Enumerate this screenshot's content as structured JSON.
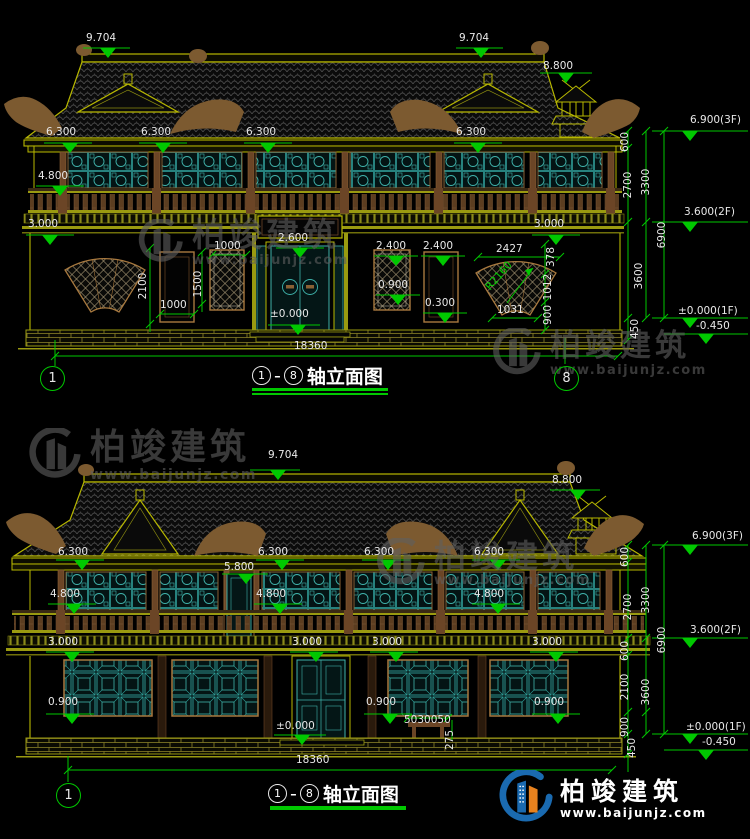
{
  "watermark": {
    "brand": "柏竣建筑",
    "url": "www.baijunjz.com"
  },
  "axes": {
    "a1": "1",
    "a8": "8"
  },
  "titles": {
    "top": "轴立面图",
    "bottom": "轴立面图",
    "separator": "-"
  },
  "lv": {
    "v9704": "9.704",
    "v8800": "8.800",
    "v6900_3f": "6.900(3F)",
    "v6300": "6.300",
    "v5800": "5.800",
    "v4800": "4.800",
    "v3600_2f": "3.600(2F)",
    "v3000": "3.000",
    "v2600": "2.600",
    "v2400": "2.400",
    "v0900": "0.900",
    "v0300": "0.300",
    "v0000": "±0.000",
    "v0000_1f": "±0.000(1F)",
    "vm0450": "-0.450"
  },
  "dm": {
    "d18360": "18360",
    "d6900": "6900",
    "d3600": "3600",
    "d3300": "3300",
    "d2700": "2700",
    "d2427": "2427",
    "d2100": "2100",
    "d1500": "1500",
    "d1031": "1031",
    "d1012": "1012",
    "d1000": "1000",
    "d900": "900",
    "d600": "600",
    "d450": "450",
    "d378": "378",
    "d275": "275",
    "d5030050": "5030050",
    "dR2160": "R2160"
  },
  "colors": {
    "background": "#000000",
    "line_yellow": "#b8b800",
    "dim_green": "#00c800",
    "window_teal": "#3fb3ab",
    "wood_brown": "#8a6134",
    "text_white": "#e8e8e8",
    "watermark_gray": "#5f5f5f",
    "logo_blue": "#1a6ab0",
    "logo_orange": "#e8821e"
  }
}
